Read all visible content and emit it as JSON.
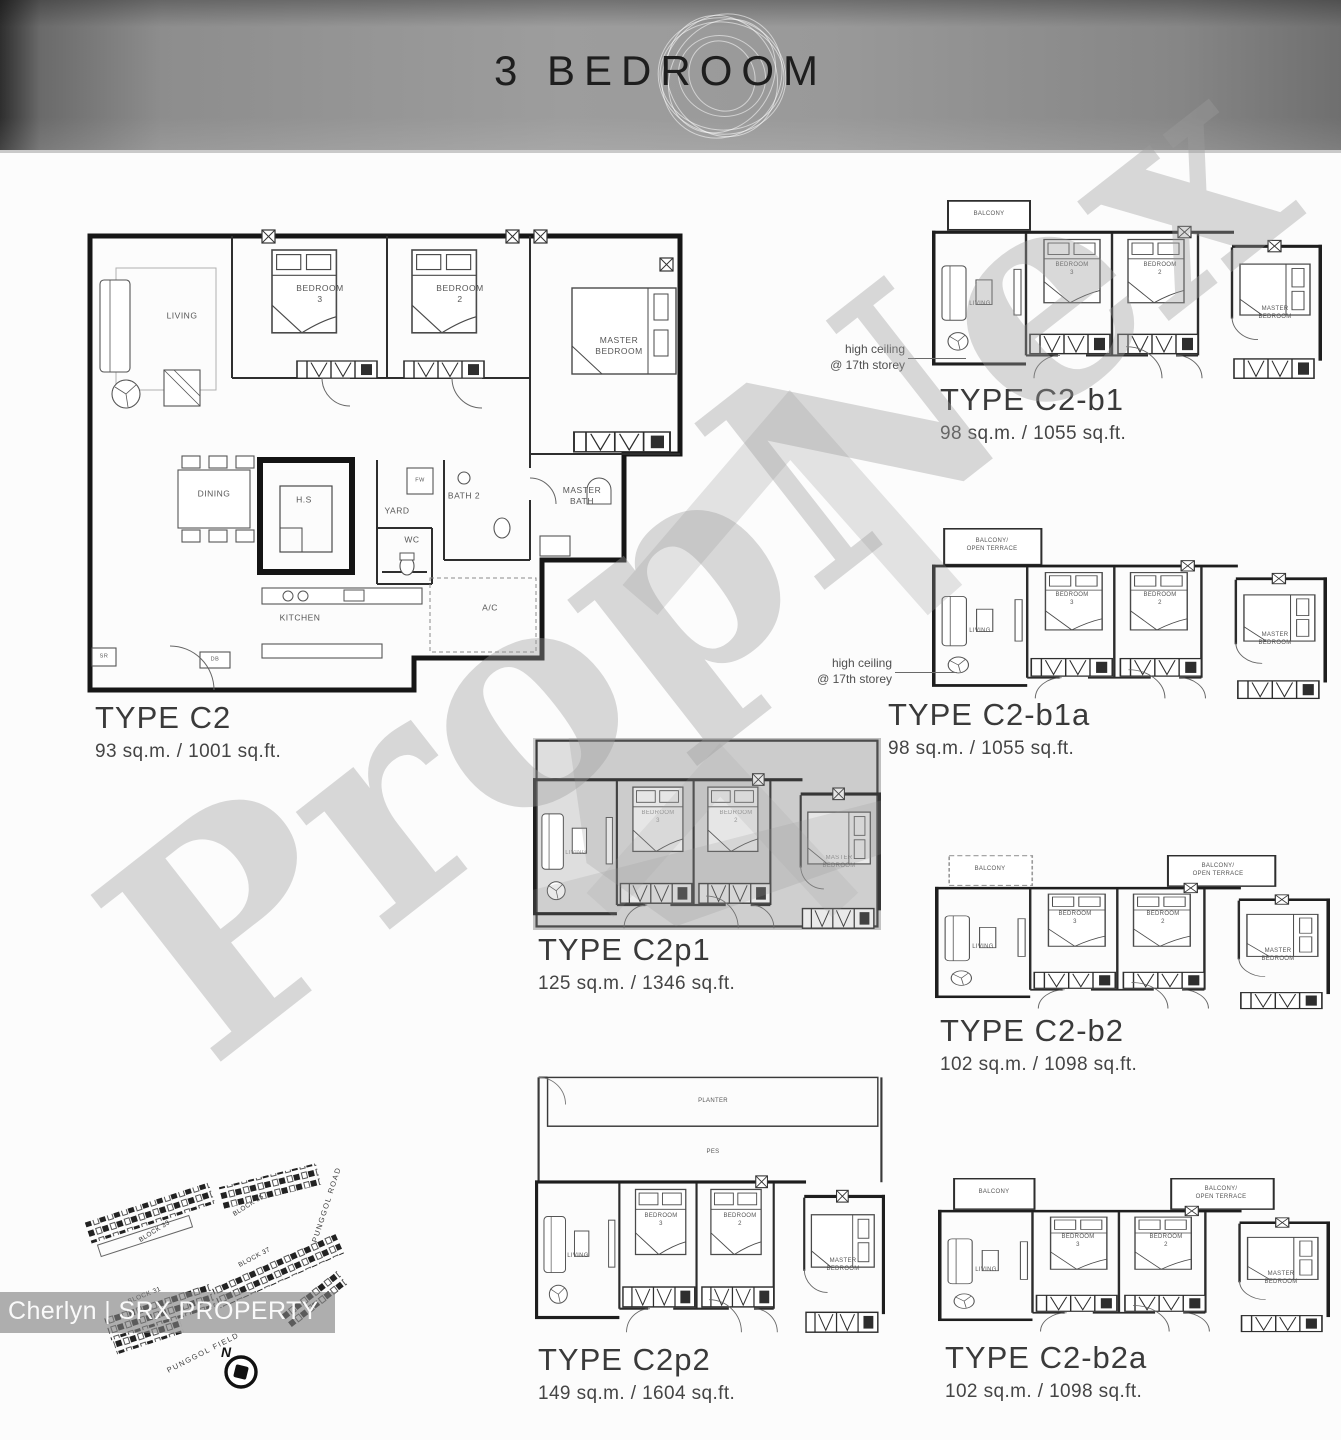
{
  "header": {
    "title": "3 BEDROOM"
  },
  "watermark": {
    "text": "PropNex"
  },
  "credit": {
    "text": "Cherlyn | SRX PROPERTY"
  },
  "plans": {
    "c2": {
      "title": "TYPE C2",
      "area": "93 sq.m. / 1001 sq.ft.",
      "rooms": {
        "living": "LIVING",
        "bedroom3": "BEDROOM\n3",
        "bedroom2": "BEDROOM\n2",
        "master": "MASTER\nBEDROOM",
        "dining": "DINING",
        "hs": "H.S",
        "yard": "YARD",
        "fw": "FW",
        "bath2": "BATH 2",
        "wc": "WC",
        "master_bath": "MASTER\nBATH",
        "kitchen": "KITCHEN",
        "ac": "A/C",
        "db": "DB",
        "sr": "SR"
      }
    },
    "c2b1": {
      "title": "TYPE C2-b1",
      "area": "98 sq.m. / 1055 sq.ft.",
      "note1": "high ceiling",
      "note2": "@ 17th storey",
      "rooms": {
        "balcony": "BALCONY",
        "living": "LIVING",
        "bedroom3": "BEDROOM\n3",
        "bedroom2": "BEDROOM\n2",
        "master": "MASTER\nBEDROOM"
      }
    },
    "c2b1a": {
      "title": "TYPE C2-b1a",
      "area": "98 sq.m. / 1055 sq.ft.",
      "note1": "high ceiling",
      "note2": "@ 17th storey",
      "rooms": {
        "balcony": "BALCONY/\nOPEN TERRACE",
        "living": "LIVING",
        "bedroom3": "BEDROOM\n3",
        "bedroom2": "BEDROOM\n2",
        "master": "MASTER\nBEDROOM"
      }
    },
    "c2p1": {
      "title": "TYPE C2p1",
      "area": "125 sq.m. / 1346 sq.ft.",
      "rooms": {
        "living": "LIVING",
        "bedroom3": "BEDROOM\n3",
        "bedroom2": "BEDROOM\n2",
        "master": "MASTER\nBEDROOM"
      }
    },
    "c2b2": {
      "title": "TYPE C2-b2",
      "area": "102 sq.m. / 1098 sq.ft.",
      "rooms": {
        "balcony": "BALCONY",
        "terrace": "BALCONY/\nOPEN TERRACE",
        "living": "LIVING",
        "bedroom3": "BEDROOM\n3",
        "bedroom2": "BEDROOM\n2",
        "master": "MASTER\nBEDROOM"
      }
    },
    "c2p2": {
      "title": "TYPE C2p2",
      "area": "149 sq.m. / 1604 sq.ft.",
      "rooms": {
        "planter": "PLANTER",
        "pes": "PES",
        "living": "LIVING",
        "bedroom3": "BEDROOM\n3",
        "bedroom2": "BEDROOM\n2",
        "master": "MASTER\nBEDROOM"
      }
    },
    "c2b2a": {
      "title": "TYPE C2-b2a",
      "area": "102 sq.m. / 1098 sq.ft.",
      "rooms": {
        "balcony": "BALCONY",
        "terrace": "BALCONY/\nOPEN TERRACE",
        "living": "LIVING",
        "bedroom3": "BEDROOM\n3",
        "bedroom2": "BEDROOM\n2",
        "master": "MASTER\nBEDROOM"
      }
    }
  },
  "site_map": {
    "punggol_road": "PUNGGOL ROAD",
    "punggol_field": "PUNGGOL FIELD",
    "block_31": "BLOCK 31",
    "block_33": "BLOCK 33",
    "block_35": "BLOCK 35",
    "block_37": "BLOCK 37",
    "north": "N"
  }
}
